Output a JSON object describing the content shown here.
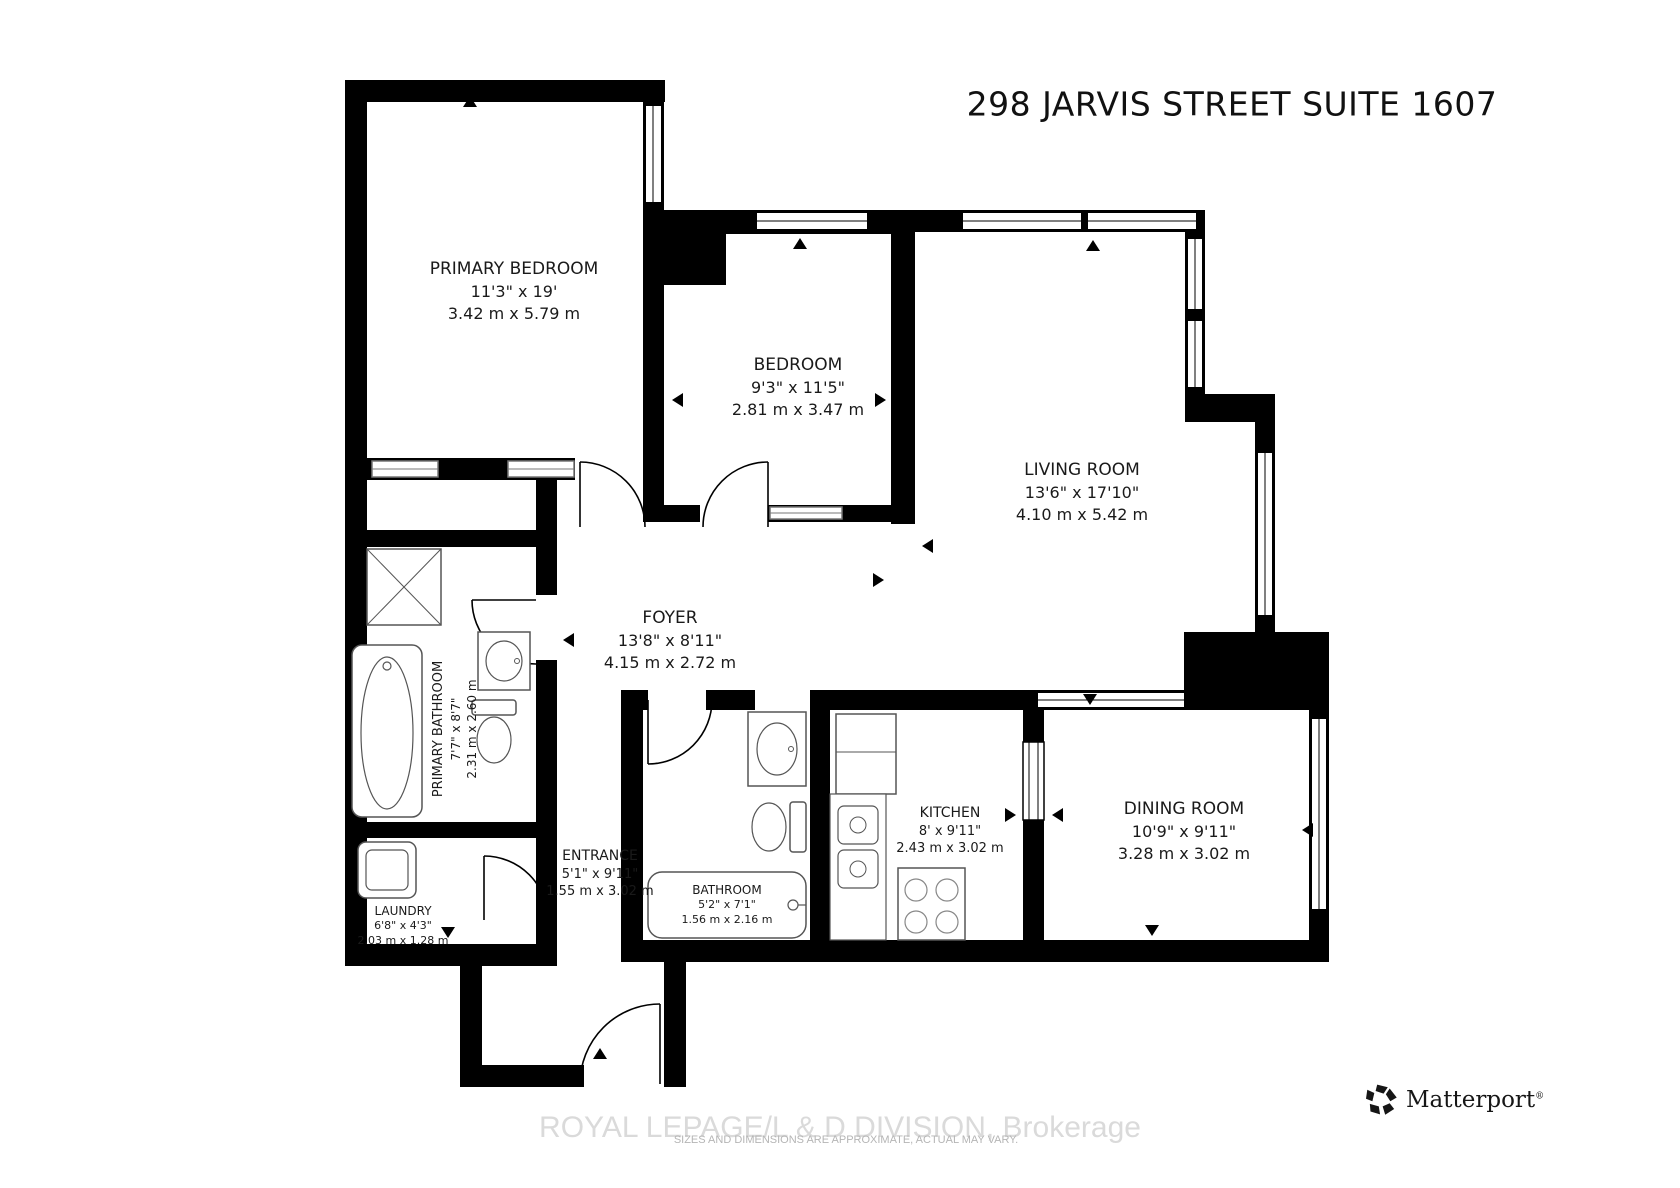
{
  "title": "298 JARVIS STREET SUITE 1607",
  "rooms": [
    {
      "id": "primary-bedroom",
      "name": "PRIMARY BEDROOM",
      "imperial": "11'3\" x 19'",
      "metric": "3.42 m x 5.79 m"
    },
    {
      "id": "bedroom",
      "name": "BEDROOM",
      "imperial": "9'3\" x 11'5\"",
      "metric": "2.81 m x 3.47 m"
    },
    {
      "id": "living-room",
      "name": "LIVING ROOM",
      "imperial": "13'6\" x 17'10\"",
      "metric": "4.10 m x 5.42 m"
    },
    {
      "id": "foyer",
      "name": "FOYER",
      "imperial": "13'8\" x 8'11\"",
      "metric": "4.15 m x 2.72 m"
    },
    {
      "id": "primary-bathroom",
      "name": "PRIMARY BATHROOM",
      "imperial": "7'7\" x 8'7\"",
      "metric": "2.31 m x 2.60 m"
    },
    {
      "id": "entrance",
      "name": "ENTRANCE",
      "imperial": "5'1\" x 9'11\"",
      "metric": "1.55 m x 3.02 m"
    },
    {
      "id": "laundry",
      "name": "LAUNDRY",
      "imperial": "6'8\" x 4'3\"",
      "metric": "2.03 m x 1.28 m"
    },
    {
      "id": "bathroom",
      "name": "BATHROOM",
      "imperial": "5'2\" x 7'1\"",
      "metric": "1.56 m x 2.16 m"
    },
    {
      "id": "kitchen",
      "name": "KITCHEN",
      "imperial": "8' x 9'11\"",
      "metric": "2.43 m x 3.02 m"
    },
    {
      "id": "dining-room",
      "name": "DINING ROOM",
      "imperial": "10'9\" x 9'11\"",
      "metric": "3.28 m x 3.02 m"
    }
  ],
  "footer": {
    "brokerage": "ROYAL LEPAGE/L & D DIVISION, Brokerage",
    "disclaimer": "SIZES AND DIMENSIONS ARE APPROXIMATE, ACTUAL MAY VARY.",
    "logo_text": "Matterport",
    "logo_registered": "®"
  },
  "colors": {
    "wall": "#000000",
    "background": "#ffffff",
    "brokerage_text": "#dadada",
    "disclaimer_text": "#b5b5b5",
    "logo_color": "#161616"
  }
}
